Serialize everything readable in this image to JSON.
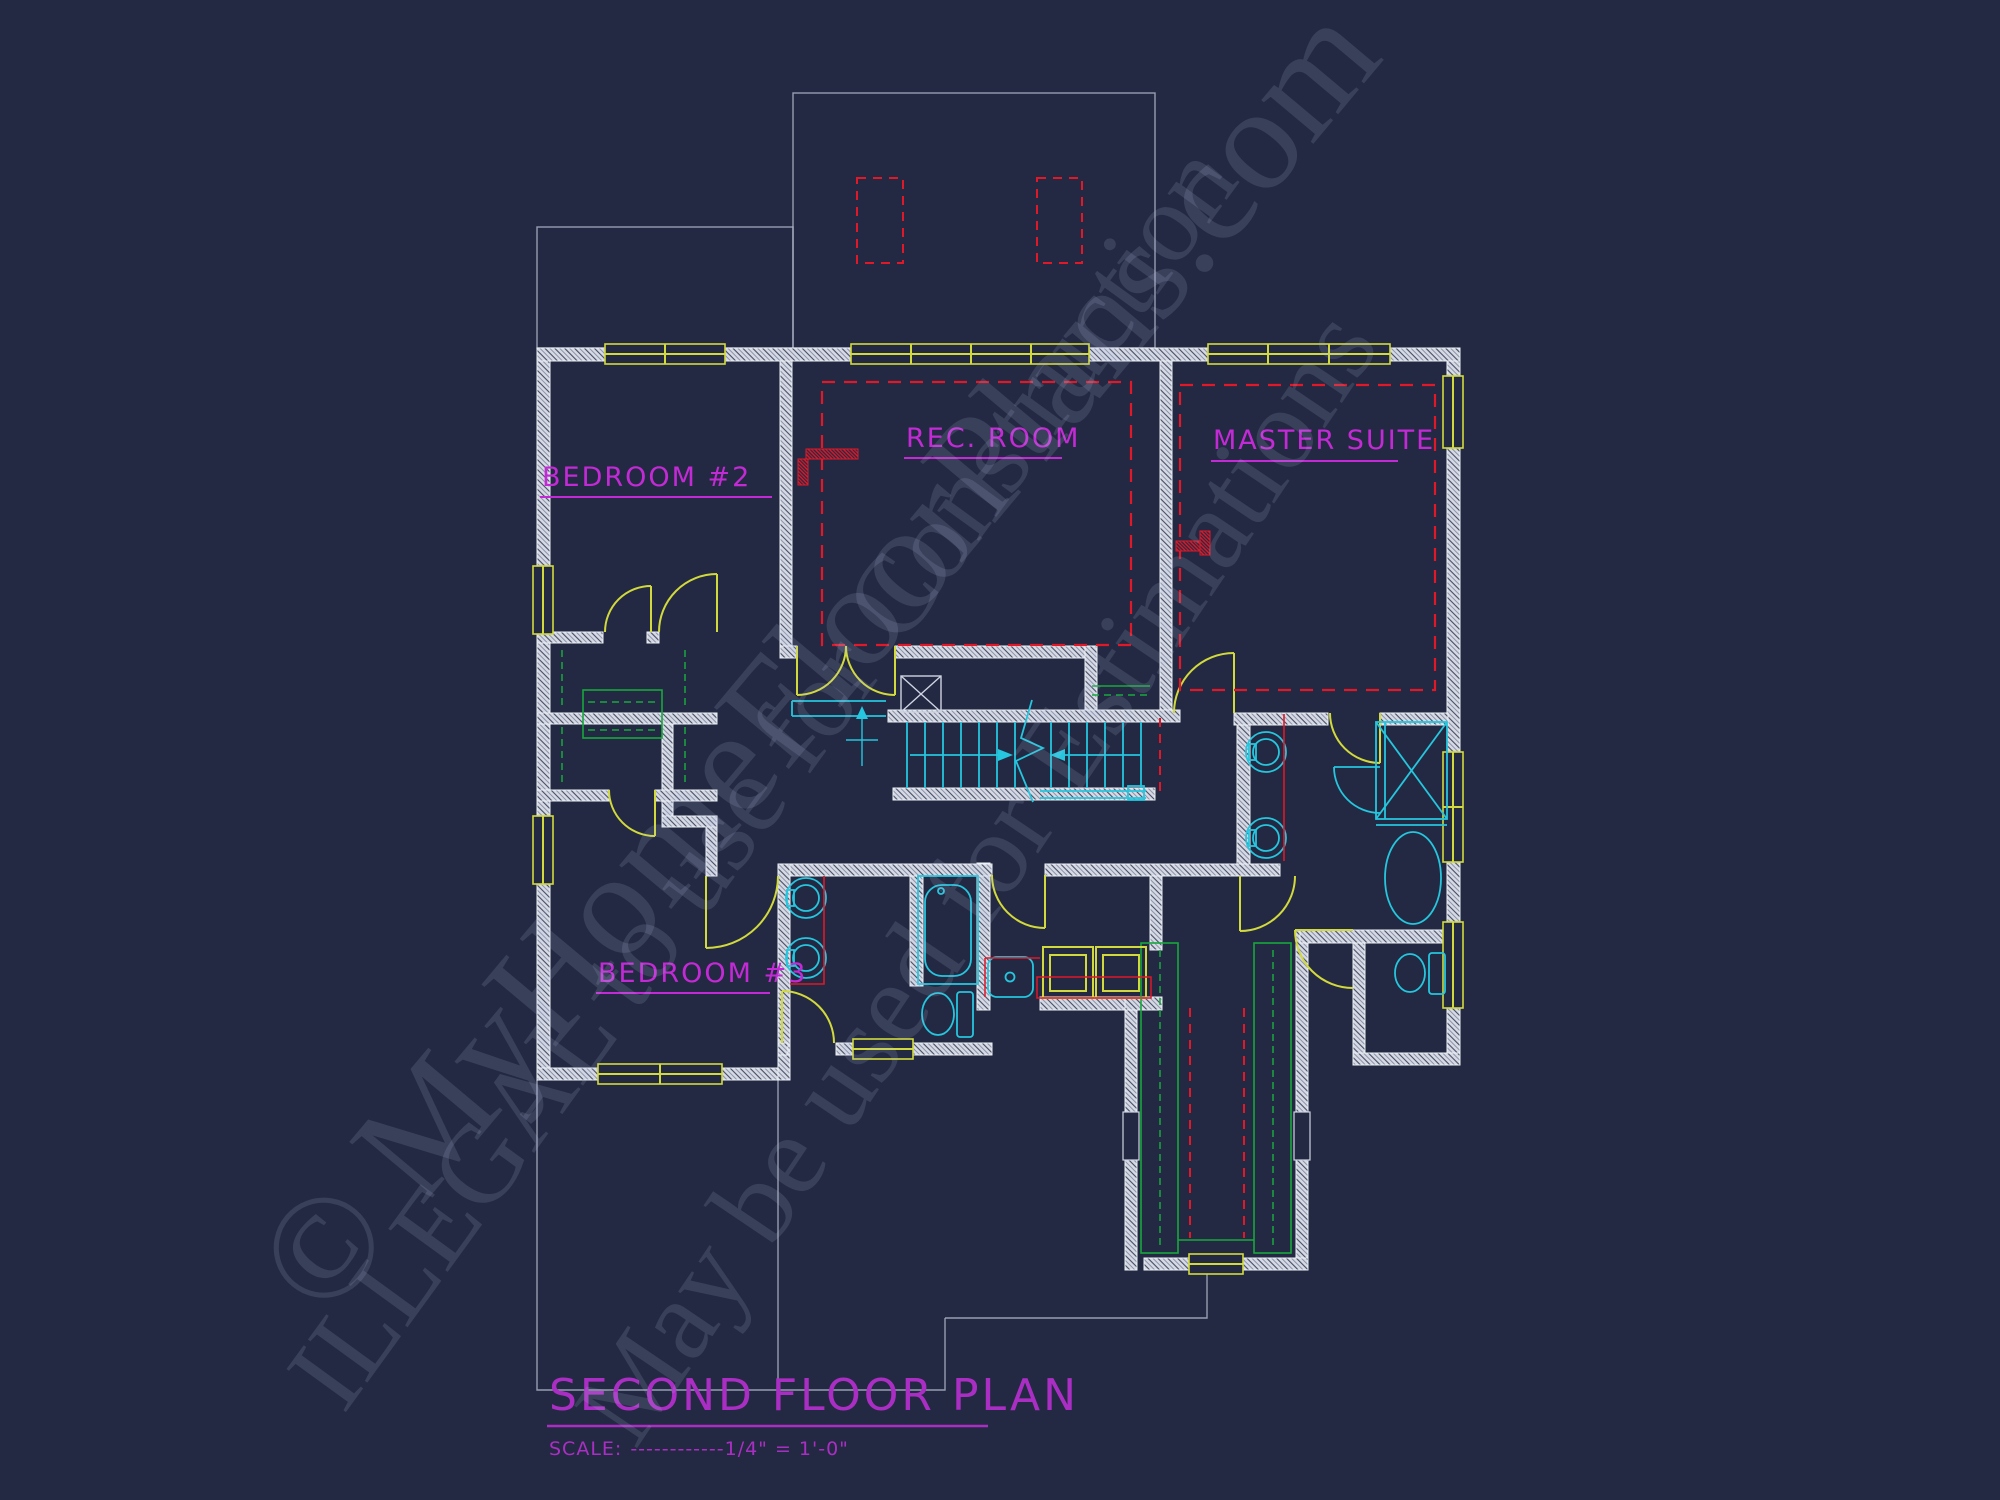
{
  "drawing": {
    "background_color": "#232942",
    "type": "architectural floor plan"
  },
  "title_block": {
    "title": "SECOND FLOOR PLAN",
    "scale_label": "SCALE:",
    "scale_value": "------------1/4\" = 1'-0\""
  },
  "rooms": {
    "bedroom2": "BEDROOM #2",
    "rec_room": "REC. ROOM",
    "master_suite": "MASTER SUITE",
    "bedroom3": "BEDROOM #3"
  },
  "watermark": {
    "line1": "© MyHomeFloorPlans.com",
    "line2": "ILLEGAL to use for Construction",
    "line3": "May be used for Estimations"
  },
  "colors": {
    "walls": "#d6dae5",
    "windows_doors": "#d2d93c",
    "labels_magenta": "#c32ad6",
    "ceiling_red": "#e01828",
    "fixtures_cyan": "#25c6de",
    "closet_green": "#17a83c",
    "roofline_gray": "#aab2c6"
  },
  "symbols": [
    "window",
    "door-swing",
    "staircase-with-break",
    "bathtub",
    "garden-tub",
    "toilet",
    "vanity-sink",
    "utility-sink",
    "shower",
    "washer-dryer",
    "closet-shelving",
    "linen-chase",
    "ceiling-tray-dashed",
    "chimney-chase"
  ]
}
